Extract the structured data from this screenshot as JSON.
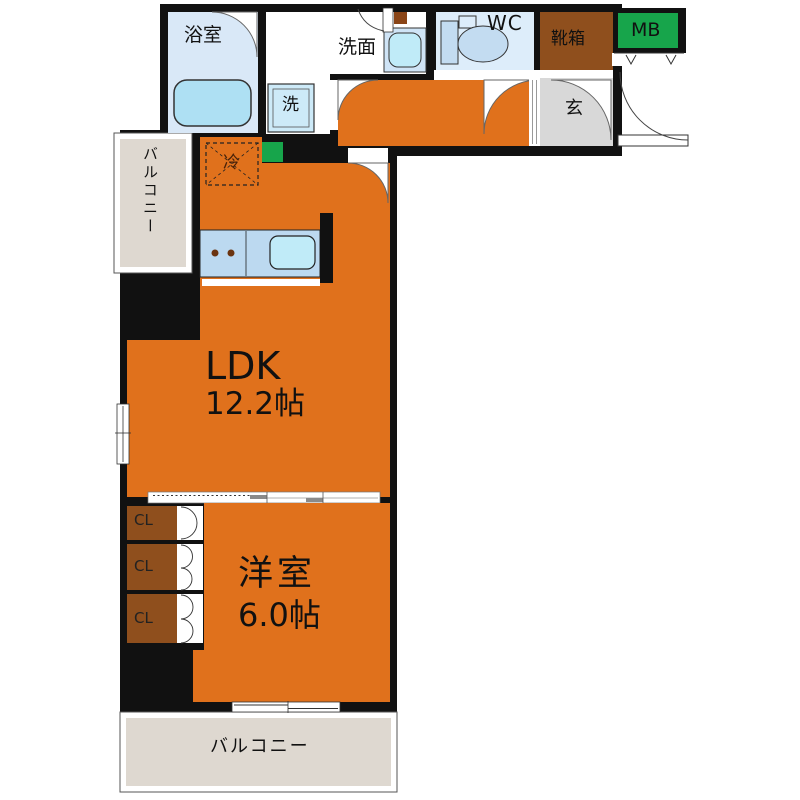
{
  "plan": {
    "type": "floorplan",
    "layout_name": "1LDK"
  },
  "rooms": {
    "bathroom": "浴室",
    "washroom": "洗面",
    "laundry": "洗",
    "wc": "WC",
    "shoebox": "靴箱",
    "meter_box": "MB",
    "entrance": "玄",
    "refrigerator": "冷",
    "ldk_name": "LDK",
    "ldk_size": "12.2帖",
    "closet1": "CL",
    "closet2": "CL",
    "closet3": "CL",
    "western_name": "洋室",
    "western_size": "6.0帖",
    "balcony_left": "バルコニー",
    "balcony_bottom": "バルコニー"
  },
  "colors": {
    "wall": "#111111",
    "floor_orange": "#e0711c",
    "closet_brown": "#8f4f1d",
    "meter_box_green": "#17a54b",
    "bathroom_blue": "#d9e8f7",
    "wc_blue": "#ddedfa",
    "fixture_blue": "#c3dcf1",
    "tub_blue": "#aee0f3",
    "counter_blue": "#bcd9f0",
    "sink_blue": "#c0ebf8",
    "entrance_gray": "#d8d8d8",
    "balcony_beige": "#ded8d0"
  }
}
